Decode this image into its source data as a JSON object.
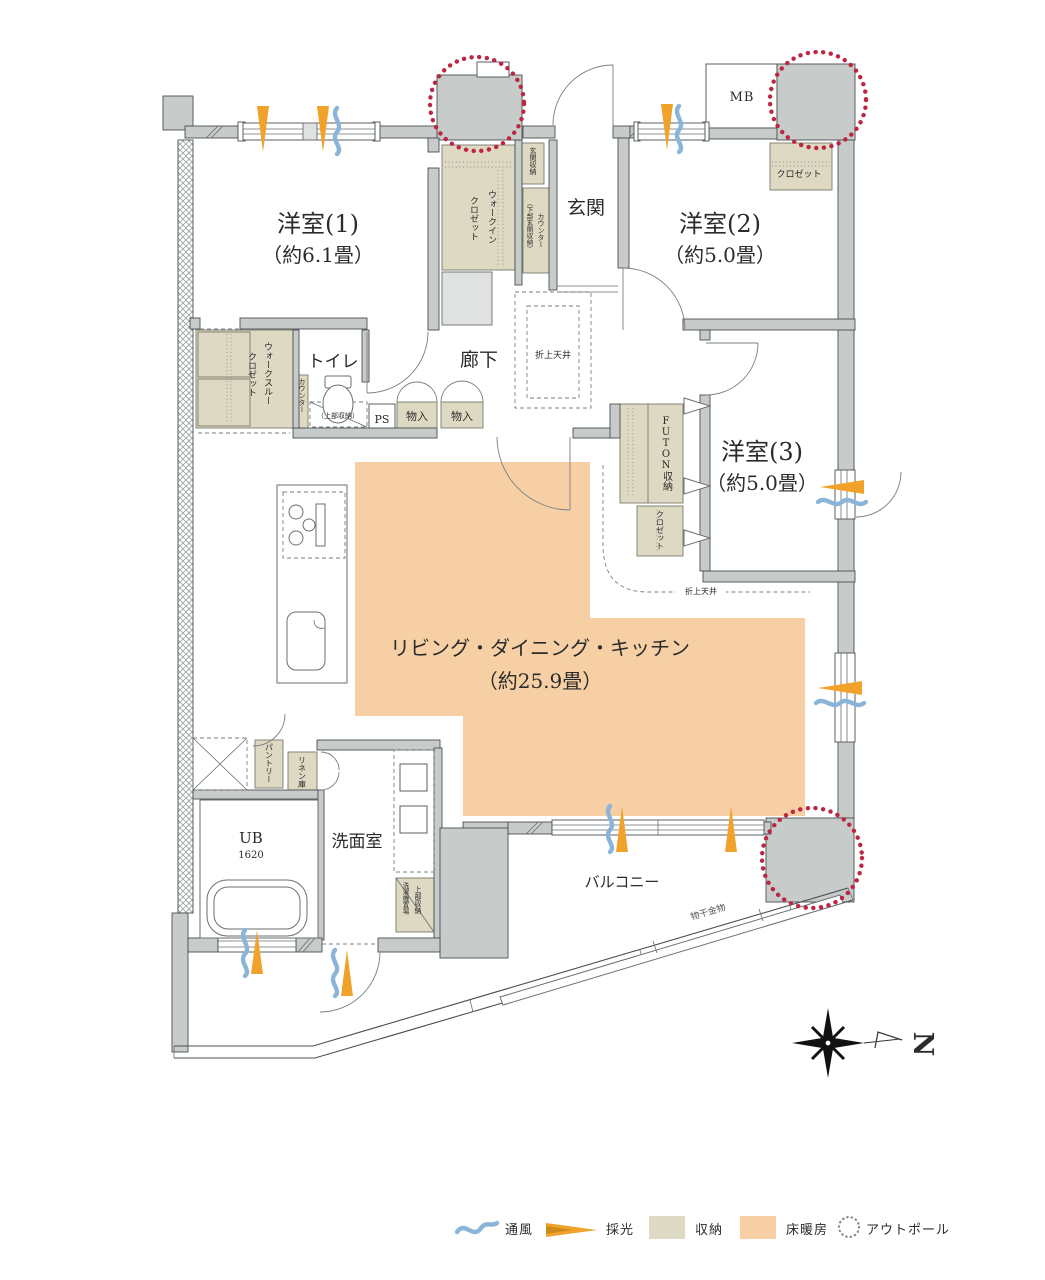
{
  "rooms": {
    "western1": {
      "name": "洋室(1)",
      "size": "（約6.1畳）"
    },
    "western2": {
      "name": "洋室(2)",
      "size": "（約5.0畳）"
    },
    "western3": {
      "name": "洋室(3)",
      "size": "（約5.0畳）"
    },
    "ldk": {
      "name": "リビング・ダイニング・キッチン",
      "size": "（約25.9畳）"
    },
    "entrance": "玄関",
    "hallway": "廊下",
    "toilet": "トイレ",
    "washroom": "洗面室",
    "bath": {
      "name": "UB",
      "size": "1620"
    },
    "balcony": "バルコニー"
  },
  "storage": {
    "wic_line1": "ウォークイン",
    "wic_line2": "クロゼット",
    "wtc_line1": "ウォークスルー",
    "wtc_line2": "クロゼット",
    "entrance_storage": "玄関収納",
    "counter": "カウンター",
    "counter_note": "（下部玄関収納）",
    "closet_w2": "クロゼット",
    "closet_w3": "クロゼット",
    "futon": "FUTON収納",
    "storage1": "物入",
    "storage2": "物入",
    "toilet_counter": "カウンター",
    "toilet_upper": "（上部収納）",
    "pantry": "パントリー",
    "linen": "リネン庫",
    "laundry_upper": "上部収納",
    "laundry": "洗濯機置場"
  },
  "annotations": {
    "mb": "MB",
    "ps": "PS",
    "ceiling1": "折上天井",
    "ceiling2": "折上天井",
    "drying": "物干金物",
    "north": "N"
  },
  "legend": {
    "items": [
      {
        "label": "通風",
        "type": "wave"
      },
      {
        "label": "採光",
        "type": "arrow"
      },
      {
        "label": "収納",
        "type": "storage-swatch"
      },
      {
        "label": "床暖房",
        "type": "heating-swatch"
      },
      {
        "label": "アウトポール",
        "type": "dotted-circle"
      }
    ]
  },
  "colors": {
    "wall": "#c7cbca",
    "storage": "#ded9c3",
    "floor_heating": "#f6d0a4",
    "outpole": "#bb2742",
    "daylight": "#f0a22a",
    "ventilation": "#8ab5d8"
  }
}
